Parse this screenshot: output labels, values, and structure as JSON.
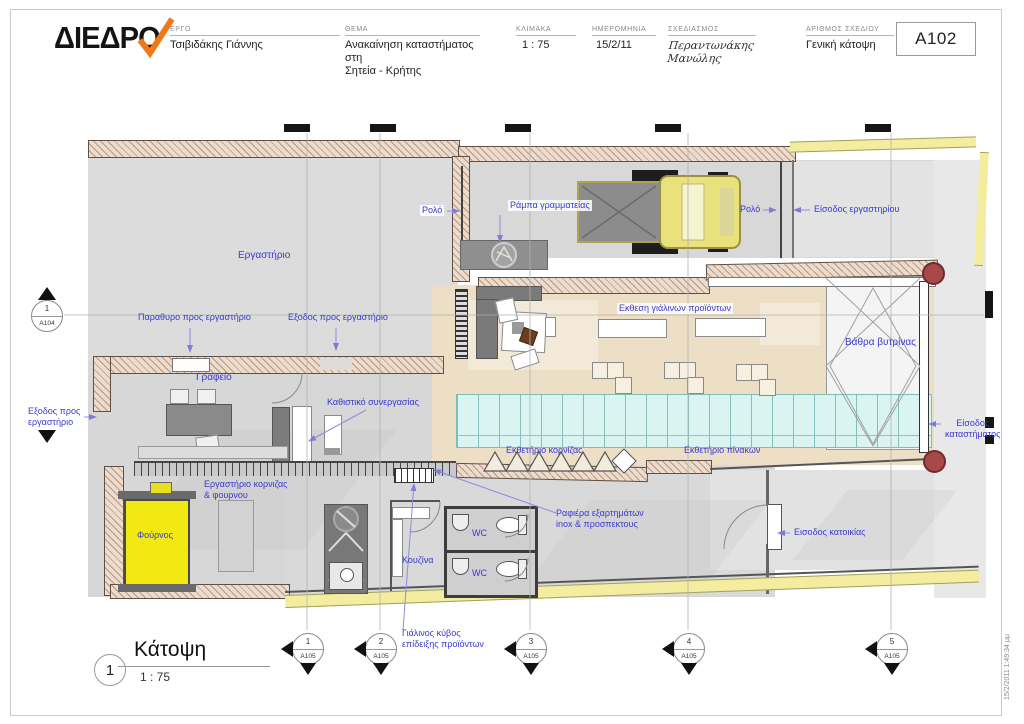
{
  "title_block": {
    "logo_text": "ΔΙΕΔΡΟ",
    "fields": [
      {
        "label": "ΕΡΓΟ",
        "value": "Τσιβιδάκης Γιάννης"
      },
      {
        "label": "ΘΕΜΑ",
        "value": "Ανακαίνηση καταστήματος στη\nΣητεία - Κρήτης"
      },
      {
        "label": "ΚΛΙΜΑΚΑ",
        "value": "1 : 75"
      },
      {
        "label": "ΗΜΕΡΟΜΗΝΙΑ",
        "value": "15/2/11"
      },
      {
        "label": "ΣΧΕΔΙΑΣΜΟΣ",
        "value": "Περαντωνάκης Μανώλης"
      },
      {
        "label": "ΑΡΙΘΜΟΣ ΣΧΕΔΙΟΥ",
        "value": "Γενική κάτοψη"
      }
    ],
    "drawing_number": "A102"
  },
  "plan_labels": {
    "rolo1": "Ρολό",
    "rampa": "Ράμπα γραμματείας",
    "ergastirio": "Εργαστήριο",
    "rolo2": "Ρολό",
    "eisodos_ergastiriou": "Είσοδος εργαστηρίου",
    "parathyro": "Παραθυρο προς εργαστήριο",
    "exodos_ergastirio": "Εξοδος προς εργαστήριο",
    "grafeio": "Γραφείο",
    "kathistiko": "Καθιστικό συνεργασίας",
    "ekthesi_gialinon": "Εκθεση γιάλινων προϊόντων",
    "vathra_vytrinas": "Βάθρα βυτρίνας",
    "exodos_left": "Εξοδος προς\nεργαστήριο",
    "eisodos_katastimatos": "Είσοδος\nκαταστήματος",
    "fournos": "Φούρνος",
    "ergastirio_kornizas": "Εργαστήριο κορνιζας\n& φουρνου",
    "kouzina": "Κουζίνα",
    "wc1": "WC",
    "wc2": "WC",
    "rafiera": "Ραφιέρα εξαρτημάτων\ninox & προσπεκτους",
    "ektheterio_kornizas": "Εκθετήριο κορνίζας",
    "ektheterio_pinakon": "Εκθετήριο πίνακων",
    "eisodos_katoikias": "Εισοδος κατοικίας",
    "gialinos_kyvos": "Γιάλινος κύβος\nεπίδειξης προϊόντων"
  },
  "markers": {
    "a104": {
      "num": "1",
      "sheet": "A104"
    },
    "b1": {
      "num": "1",
      "sheet": "A105"
    },
    "b2": {
      "num": "2",
      "sheet": "A105"
    },
    "b3": {
      "num": "3",
      "sheet": "A105"
    },
    "b4": {
      "num": "4",
      "sheet": "A105"
    },
    "b5": {
      "num": "5",
      "sheet": "A105"
    }
  },
  "view": {
    "num": "1",
    "title": "Κάτοψη",
    "scale": "1 : 75"
  },
  "timestamp": "15/2/2011 1:49:34 μμ",
  "colors": {
    "label_blue": "#3939cf",
    "wall_hatch": "#b99681",
    "showroom_beige": "#ecdfc6",
    "counter_cyan": "#daf4f2",
    "car_yellow": "#e9e17b",
    "oven_yellow": "#f2e913",
    "sidewalk_yellow": "#f4eda0",
    "column_red": "#a84848",
    "logo_check_orange": "#f07818"
  }
}
